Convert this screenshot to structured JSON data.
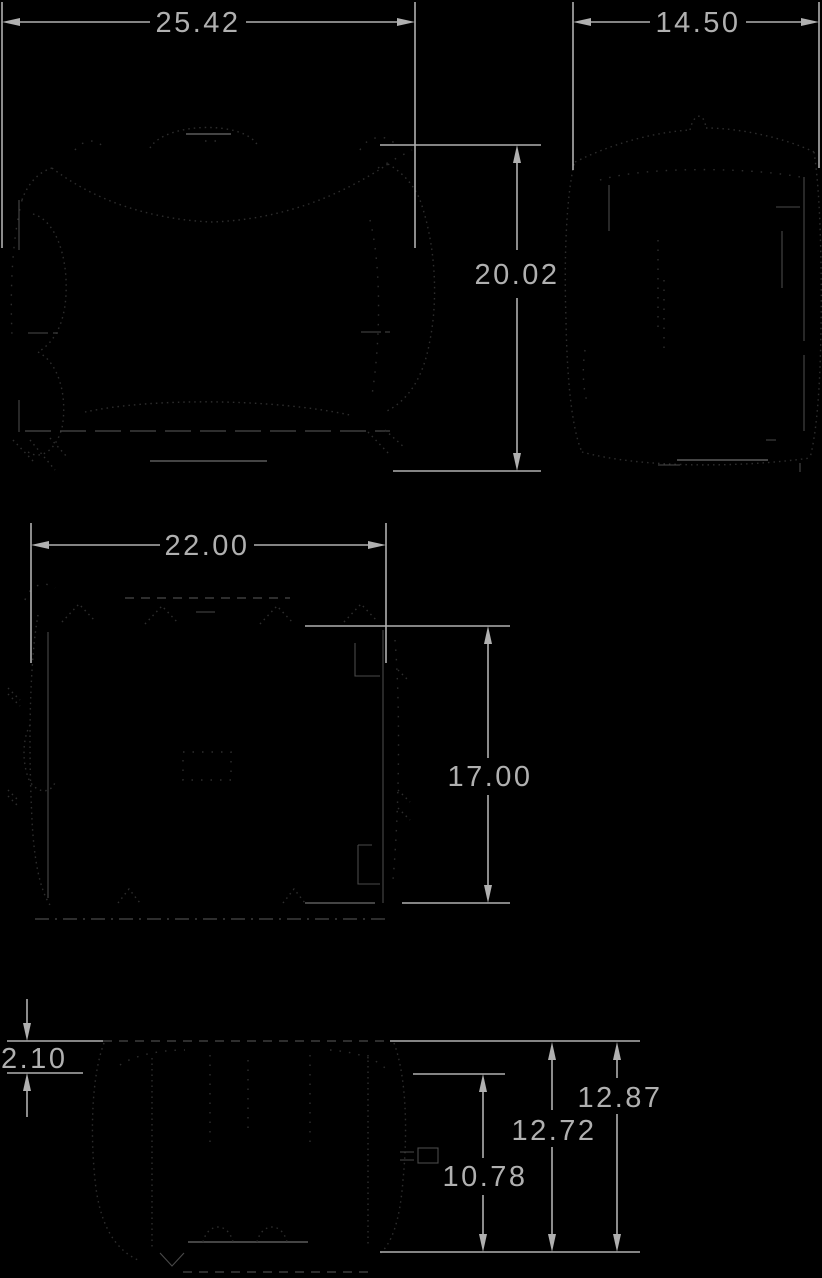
{
  "colors": {
    "background": "#000000",
    "dimension": "#b0b0b0",
    "detail": "#6e6e6e",
    "faint": "#4a4a4a",
    "stipple": "#2e2e2e"
  },
  "dimensions": {
    "front_view": {
      "width": "25.42",
      "height": "20.02"
    },
    "side_view": {
      "width": "14.50"
    },
    "rear_view": {
      "width": "22.00",
      "height": "17.00"
    },
    "bottom_view": {
      "lip_height": "2.10",
      "port_height": "10.78",
      "ledge_height": "12.72",
      "overall_height": "12.87"
    }
  }
}
